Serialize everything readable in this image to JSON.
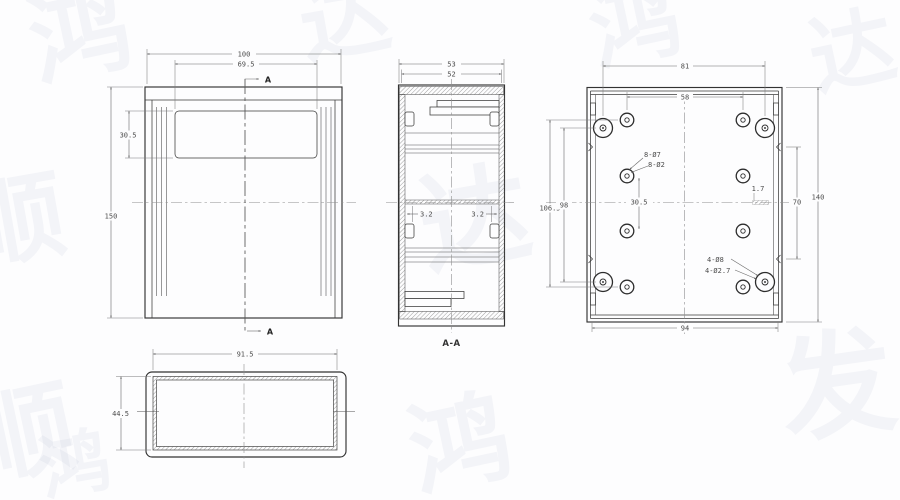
{
  "drawing": {
    "colors": {
      "object_line": "#333333",
      "dimension_line": "#6a6a6a",
      "centerline": "#8f8f8f",
      "dim_text": "#4c4c4c",
      "background": "#fdfdfe",
      "watermark": "rgba(140,158,188,0.09)"
    },
    "views": {
      "front": {
        "dim_overall_width": "100",
        "dim_window_width": "69.5",
        "dim_window_height": "30.5",
        "dim_overall_height": "150",
        "section_arrow_top": "A",
        "section_arrow_bottom": "A"
      },
      "section": {
        "dim_outer_width": "53",
        "dim_inner_width": "52",
        "dim_wall_left": "3.2",
        "dim_wall_right": "3.2",
        "view_label": "A-A"
      },
      "back": {
        "dim_corner_hole_span": "81",
        "dim_small_hole_span": "58",
        "dim_row_gap": "30.5",
        "dim_left_outer": "106.5",
        "dim_left_inner": "98",
        "dim_notch": "1.7",
        "dim_notch_span": "70",
        "dim_overall_height": "140",
        "dim_bottom_width": "94",
        "callout_small_1": "8-Ø7",
        "callout_small_2": "8-Ø2",
        "callout_corner_1": "4-Ø8",
        "callout_corner_2": "4-Ø2.7"
      },
      "bottom": {
        "dim_width": "91.5",
        "dim_height": "44.5"
      }
    },
    "watermarks": [
      "鸿",
      "达",
      "鸿",
      "顺",
      "顺",
      "达",
      "达",
      "发",
      "鸿",
      "鸿"
    ]
  }
}
